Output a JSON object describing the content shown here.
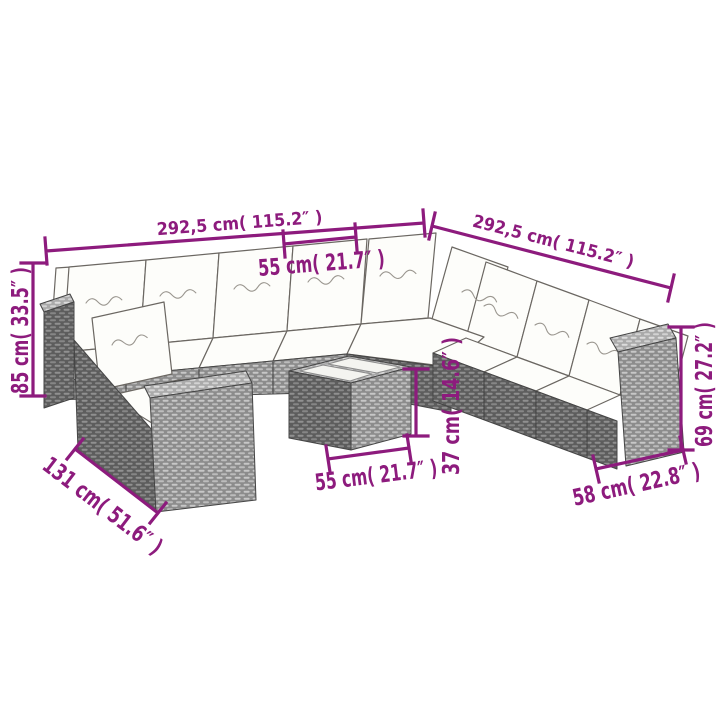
{
  "diagram": {
    "background": "#ffffff",
    "accent_color": "#8D1B7D",
    "description": "Poly rattan garden lounge set with cushions and coffee table, dimension diagram",
    "dimensions": [
      {
        "name": "back-row-width",
        "label": "292,5 cm( 115.2″ )"
      },
      {
        "name": "right-row-width",
        "label": "292,5 cm( 115.2″ )"
      },
      {
        "name": "seat-module-width",
        "label": "55 cm( 21.7″ )"
      },
      {
        "name": "backrest-height",
        "label": "85 cm( 33.5″ )"
      },
      {
        "name": "chaise-length",
        "label": "131 cm( 51.6″ )"
      },
      {
        "name": "table-width",
        "label": "55 cm( 21.7″ )"
      },
      {
        "name": "table-height",
        "label": "37 cm( 14.6″ )"
      },
      {
        "name": "arm-height",
        "label": "69 cm( 27.2″ )"
      },
      {
        "name": "arm-module-width",
        "label": "58 cm( 22.8″ )"
      }
    ]
  }
}
